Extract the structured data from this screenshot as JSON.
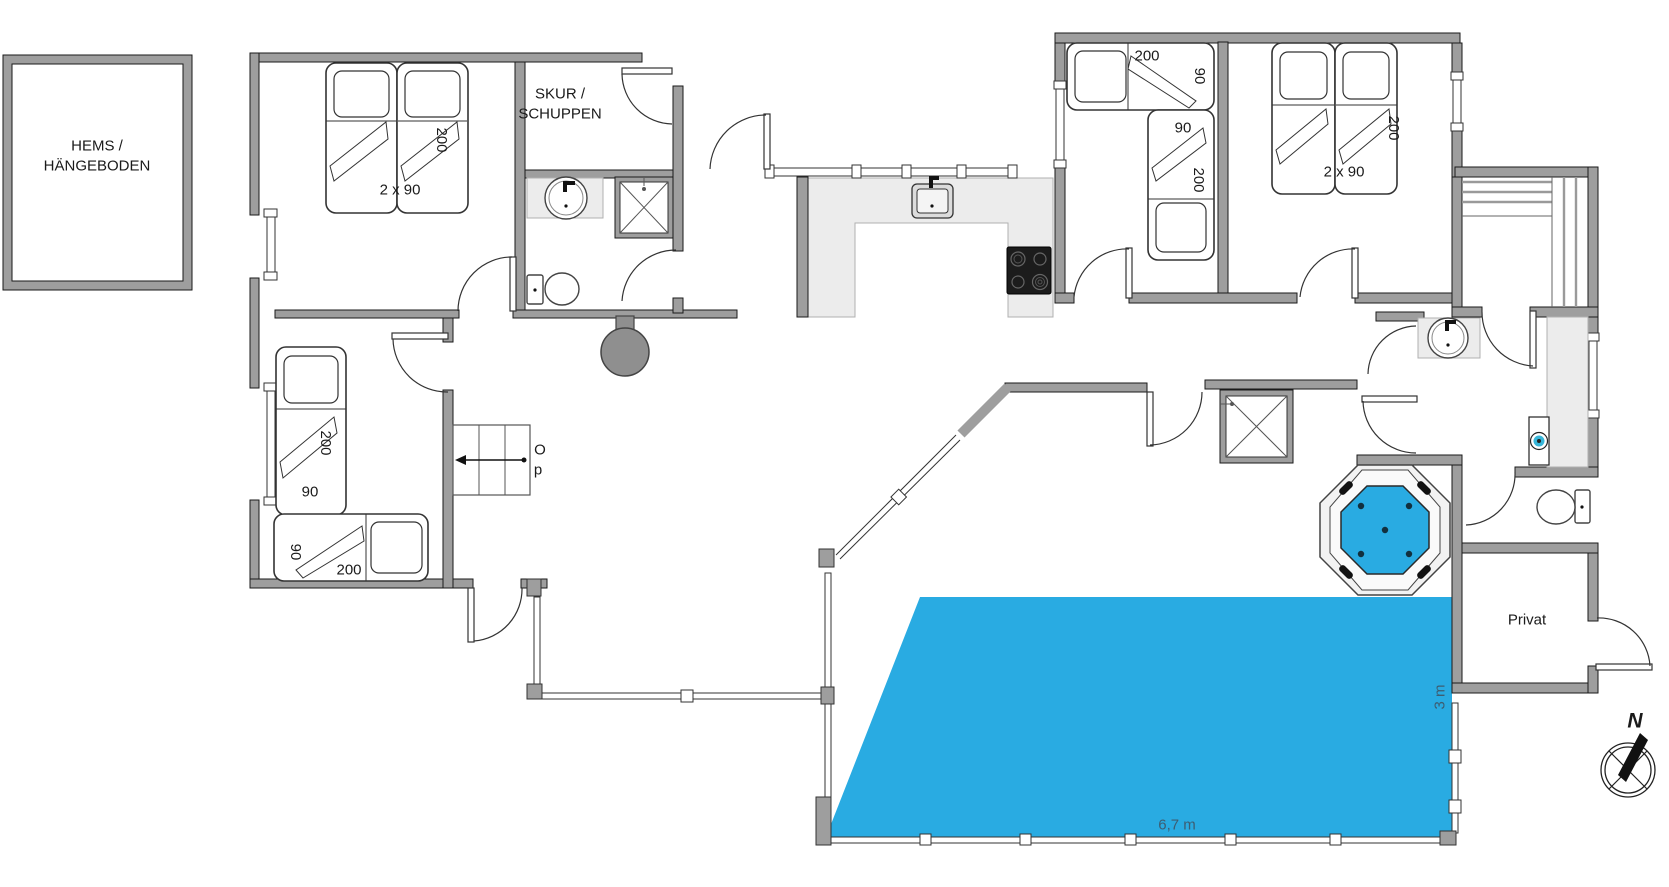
{
  "floorplan": {
    "annex": {
      "label": "HEMS /\nHÄNGEBODEN"
    },
    "shed": {
      "label": "SKUR /\nSCHUPPEN"
    },
    "private_room": {
      "label": "Privat"
    },
    "stairs": {
      "up_label_line1": "O",
      "up_label_line2": "p"
    },
    "compass": {
      "north": "N"
    },
    "pool": {
      "length": "6,7 m",
      "width": "3 m"
    },
    "beds": {
      "tl_twin_length": "200",
      "tl_twin_size": "2 x 90",
      "ll_single_a_length": "200",
      "ll_single_a_width": "90",
      "ll_single_b_width": "90",
      "ll_single_b_length": "200",
      "r1_single_a_length": "200",
      "r1_single_a_width": "90",
      "r1_single_b_width": "90",
      "r1_single_b_length": "200",
      "r2_twin_length": "200",
      "r2_twin_size": "2 x 90"
    },
    "colors": {
      "wall": "#9e9e9e",
      "wall_outline": "#1a1a1a",
      "water": "#29abe2",
      "counter": "#ececec",
      "appliance_dark": "#1c1c1c",
      "stove_gray": "#8f8f8f",
      "dim_text": "#3d5d72",
      "washer_accent": "#37b6d9"
    }
  }
}
